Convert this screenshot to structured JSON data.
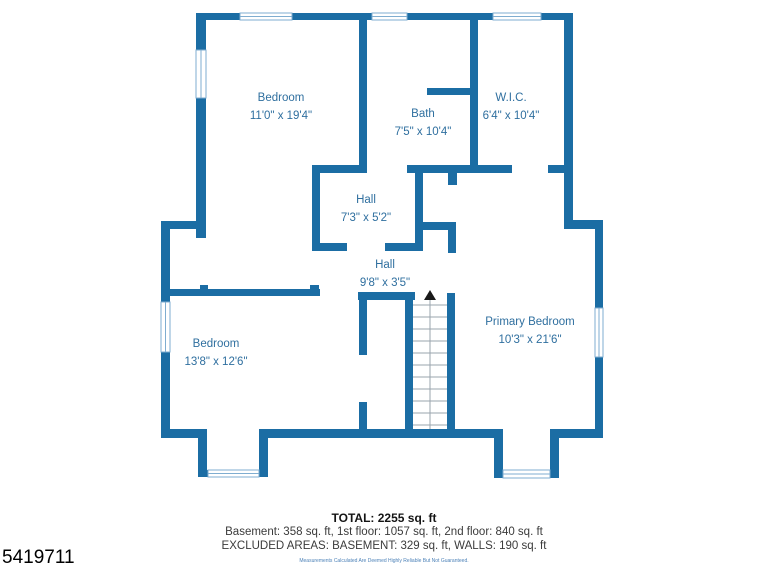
{
  "plan": {
    "rooms": [
      {
        "name": "Bedroom",
        "dims": "11'0\" x 19'4\""
      },
      {
        "name": "Bath",
        "dims": "7'5\" x 10'4\""
      },
      {
        "name": "W.I.C.",
        "dims": "6'4\" x 10'4\""
      },
      {
        "name": "Hall",
        "dims": "7'3\" x 5'2\""
      },
      {
        "name": "Hall",
        "dims": "9'8\" x 3'5\""
      },
      {
        "name": "Bedroom",
        "dims": "13'8\" x 12'6\""
      },
      {
        "name": "Primary Bedroom",
        "dims": "10'3\" x 21'6\""
      }
    ],
    "stairs_direction": "up",
    "colors": {
      "wall": "#1b6da4",
      "label": "#2f6f9f",
      "window_frame": "#7fadd0",
      "stair_tread": "#9aa4ad",
      "stair_arrow": "#1a1a1a"
    }
  },
  "summary": {
    "total": "TOTAL: 2255 sq. ft",
    "floors": "Basement: 358 sq. ft, 1st floor: 1057 sq. ft, 2nd floor: 840 sq. ft",
    "excluded": "EXCLUDED AREAS: BASEMENT: 329 sq. ft, WALLS: 190 sq. ft",
    "disclaimer": "Measurements Calculated Are Deemed Highly Reliable But Not Guaranteed.",
    "listing_id": "5419711"
  }
}
